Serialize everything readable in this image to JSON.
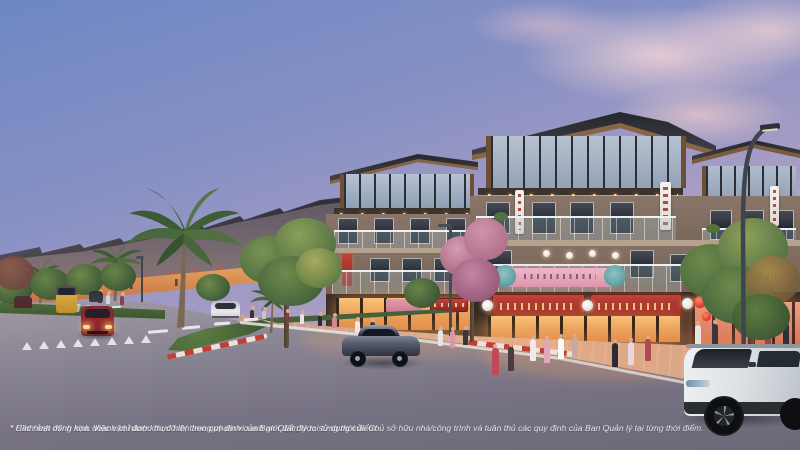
{
  "disclaimer": {
    "line1": "* Hình ảnh minh họa. Việc vận hành khu đô thị theo quy định của Ban Quản lý tại từng thời điểm.",
    "line2": "* Các hoạt động kinh doanh chỉ được thực hiện trong phạm vi ranh giới đất được sử dụng của Chủ sở hữu nhà/công trình và tuân thủ các quy định của Ban Quản lý tại từng thời điểm."
  },
  "scene": {
    "type": "architectural-render",
    "setting": "dusk shophouse boulevard with palm-lined median",
    "elements": [
      "sky-dusk-clouds",
      "far-shophouse-row",
      "shophouse-b",
      "main-shophouse",
      "palm-trees",
      "median-island",
      "boulevard-road",
      "paved-sidewalk",
      "street-lamp",
      "pedestrians",
      "storefront-lanterns"
    ],
    "vehicles": [
      {
        "name": "city-bus",
        "color": "#d9a93c"
      },
      {
        "name": "small-gray-car",
        "color": "#3b3a44"
      },
      {
        "name": "red-car",
        "color": "#93252b"
      },
      {
        "name": "white-sedan",
        "color": "#e8eaee"
      },
      {
        "name": "gray-sports-sedan",
        "color": "#4e5565"
      },
      {
        "name": "white-suv",
        "color": "#e2e6e9"
      }
    ],
    "colors": {
      "sky_top": "#6d87c3",
      "sky_horizon": "#d7bfc8",
      "cloud_pink": "#e3c2c8",
      "building_wall": "#8a7568",
      "roof_dark": "#2e2f36",
      "wood_trim": "#8a6544",
      "storefront_glow": "#f0a85c",
      "sign_red": "#b23530",
      "lantern_red": "#d0382c",
      "median_green": "#4f6b3c",
      "curb_red_white": "#c23f36",
      "road_gray": "#7b7583",
      "sidewalk_paver": "#cf9f8d"
    }
  }
}
